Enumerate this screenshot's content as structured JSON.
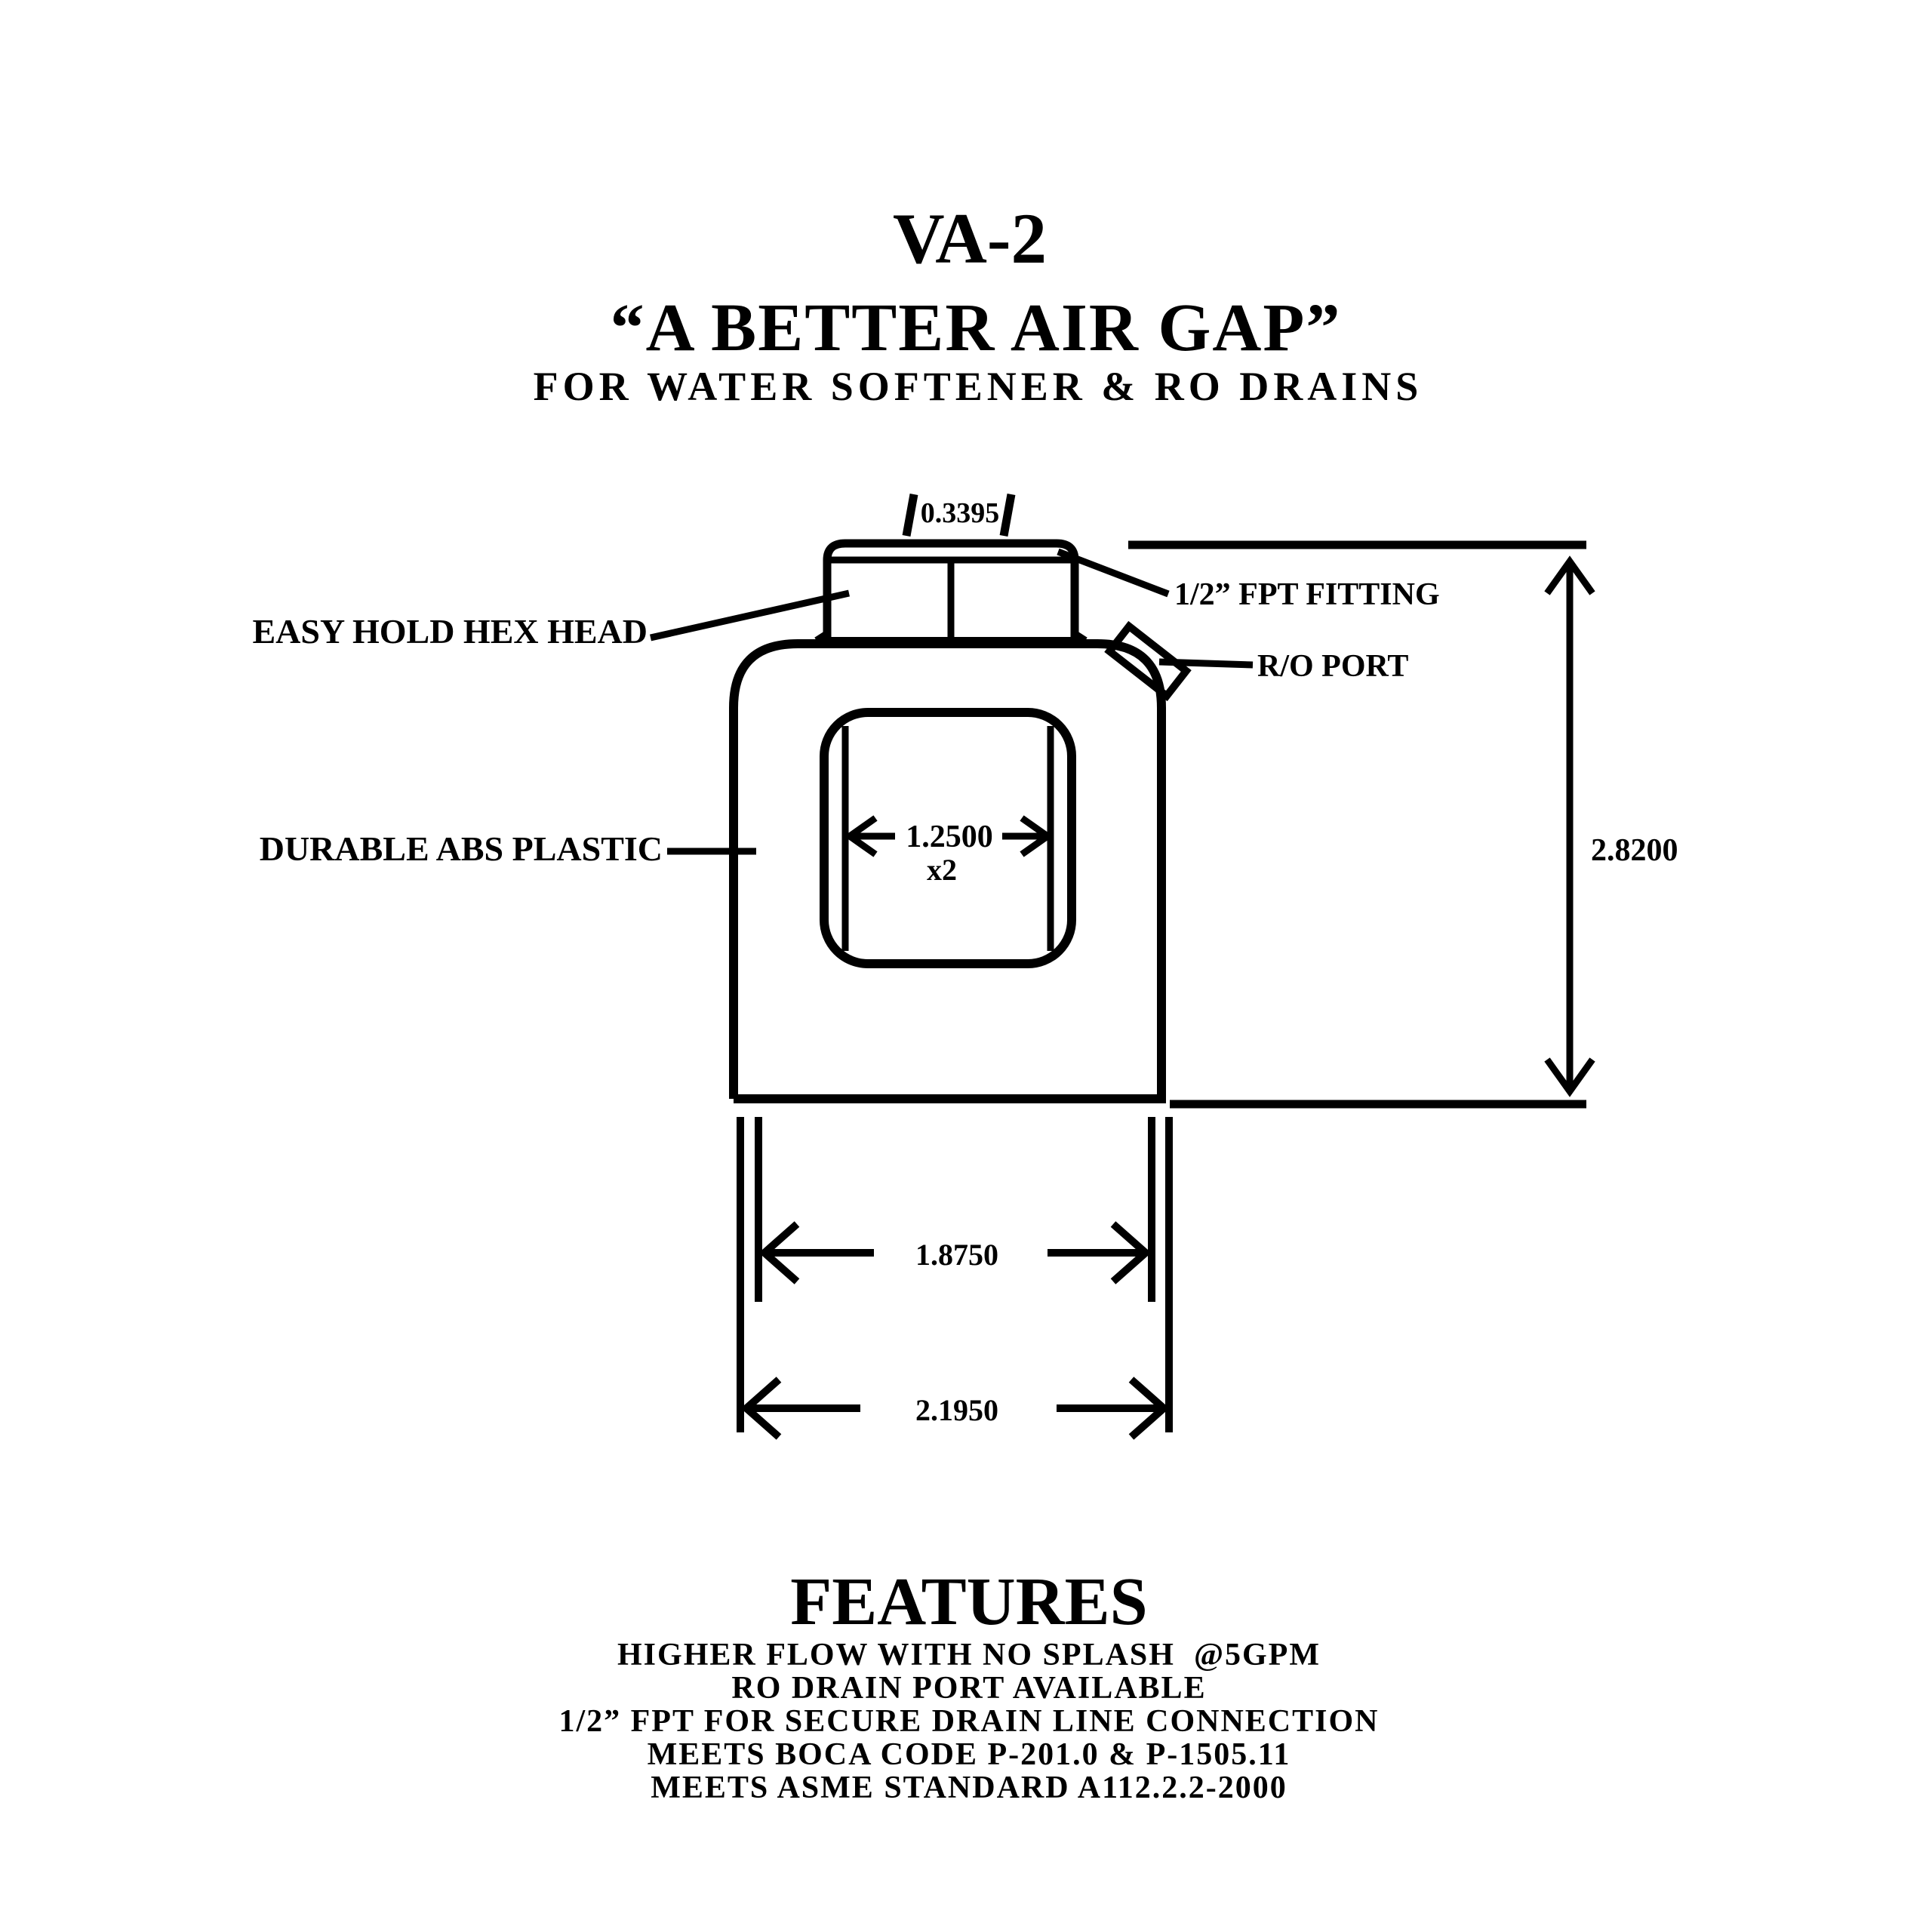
{
  "title": {
    "model": "VA-2",
    "tagline": "“A BETTER AIR GAP”",
    "subtitle": "FOR WATER SOFTENER & RO DRAINS"
  },
  "labels": {
    "hex_head": "EASY HOLD HEX HEAD",
    "fpt_fitting": "1/2” FPT FITTING",
    "ro_port": "R/O PORT",
    "abs_plastic": "DURABLE ABS PLASTIC"
  },
  "dimensions": {
    "cap_width": "0.3395",
    "window_width": "1.2500",
    "window_qty": "x2",
    "overall_height": "2.8200",
    "inner_width": "1.8750",
    "outer_width": "2.1950"
  },
  "features": {
    "heading": "FEATURES",
    "items": [
      "HIGHER FLOW WITH NO SPLASH  @5GPM",
      "RO DRAIN PORT AVAILABLE",
      "1/2” FPT FOR SECURE DRAIN LINE CONNECTION",
      "MEETS BOCA CODE P-201.0 & P-1505.11",
      "MEETS ASME STANDARD A112.2.2-2000"
    ]
  },
  "colors": {
    "ink": "#000000",
    "background": "#ffffff"
  }
}
